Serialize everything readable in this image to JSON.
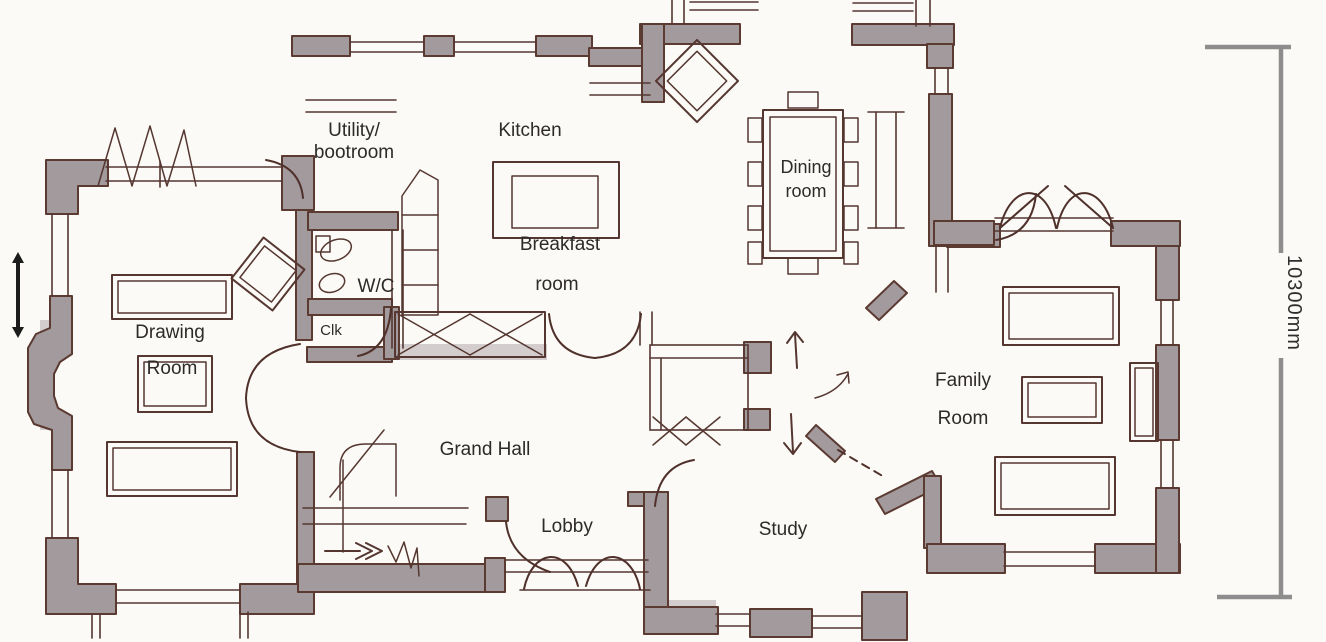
{
  "rooms": {
    "utility": {
      "line1": "Utility/",
      "line2": "bootroom"
    },
    "kitchen": {
      "line1": "Kitchen"
    },
    "breakfast": {
      "line1": "Breakfast",
      "line2": "room"
    },
    "wc": {
      "line1": "W/C"
    },
    "cloak": {
      "line1": "Clk"
    },
    "dining": {
      "line1": "Dining",
      "line2": "room"
    },
    "drawing": {
      "line1": "Drawing",
      "line2": "Room"
    },
    "grand_hall": {
      "line1": "Grand Hall"
    },
    "lobby": {
      "line1": "Lobby"
    },
    "study": {
      "line1": "Study"
    },
    "family": {
      "line1": "Family",
      "line2": "Room"
    }
  },
  "dimension": {
    "label": "10300mm"
  },
  "colors": {
    "paper": "#fbfaf6",
    "wall_fill": "#a39a9d",
    "ink": "#553630",
    "dimension_gray": "#8d8d8d",
    "label_text": "#2d2a29"
  }
}
